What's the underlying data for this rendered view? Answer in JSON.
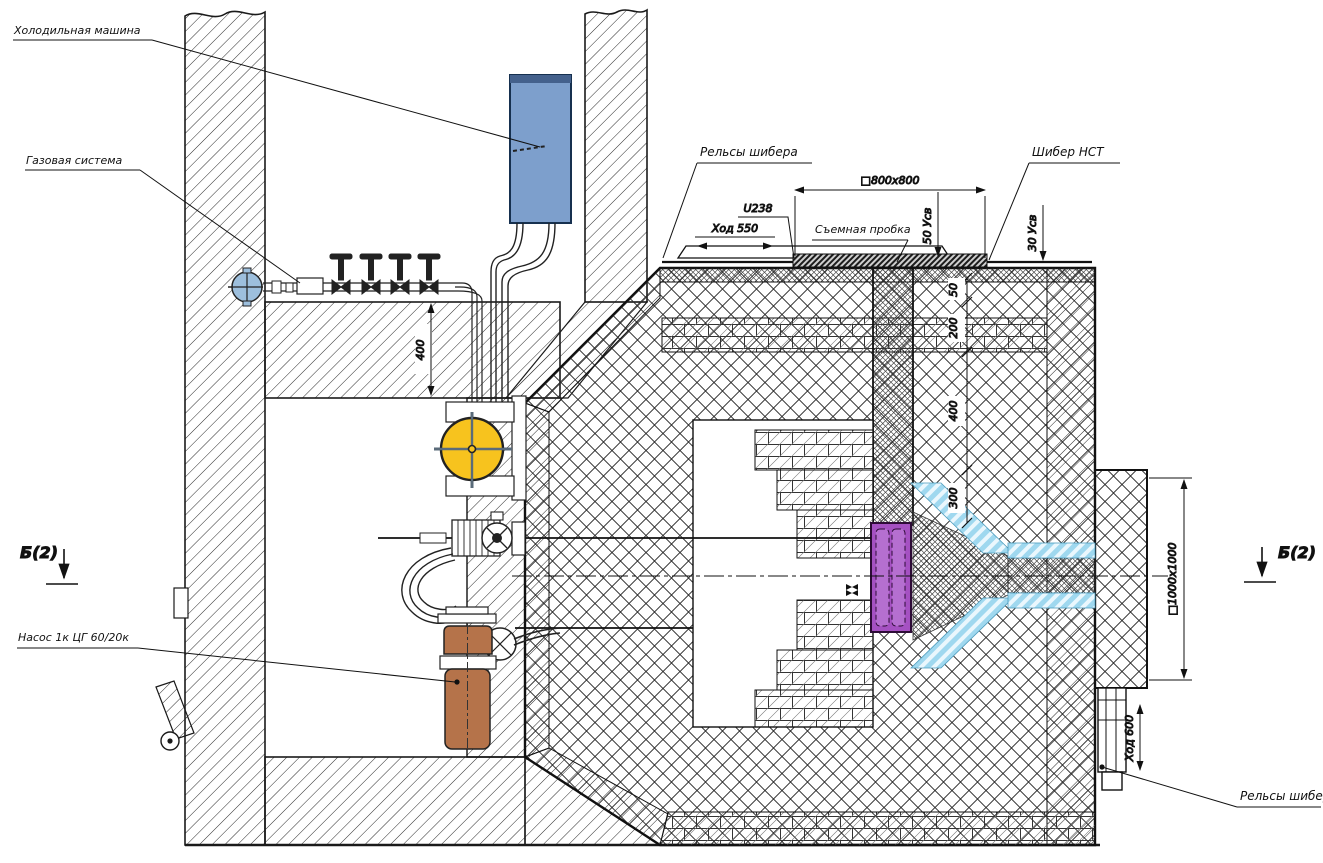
{
  "drawing": {
    "equipment_labels": {
      "refrigeration_machine": "Холодильная машина",
      "gas_system": "Газовая система",
      "pump": "Насос 1к ЦГ 60/20к",
      "shiber_rails_top": "Рельсы шибера",
      "shiber_nst": "Шибер НСТ",
      "removable_plug": "Съемная пробка",
      "shiber_rails_bottom": "Рельсы шибера"
    },
    "section_marks": {
      "left": "Б(2)",
      "right": "Б(2)"
    },
    "dimensions": {
      "stroke_top": "Ход 550",
      "rail_profile": "U238",
      "opening_top": "□800х800",
      "weld_gap_50": "50 Усв",
      "weld_gap_30": "30 Усв",
      "ceiling_thickness": "400",
      "layer_50": "50",
      "layer_200": "200",
      "layer_400": "400",
      "layer_300": "300",
      "opening_side": "□1000х1000",
      "stroke_bottom": "Ход 600"
    },
    "colors": {
      "machine_blue": "#7d9fcc",
      "valve_blue": "#9dbfdd",
      "fan_yellow": "#f7c31e",
      "pump_brown": "#b5734a",
      "nozzle_purple": "#a551c2",
      "channel_cyan": "#9fd8ef"
    }
  }
}
